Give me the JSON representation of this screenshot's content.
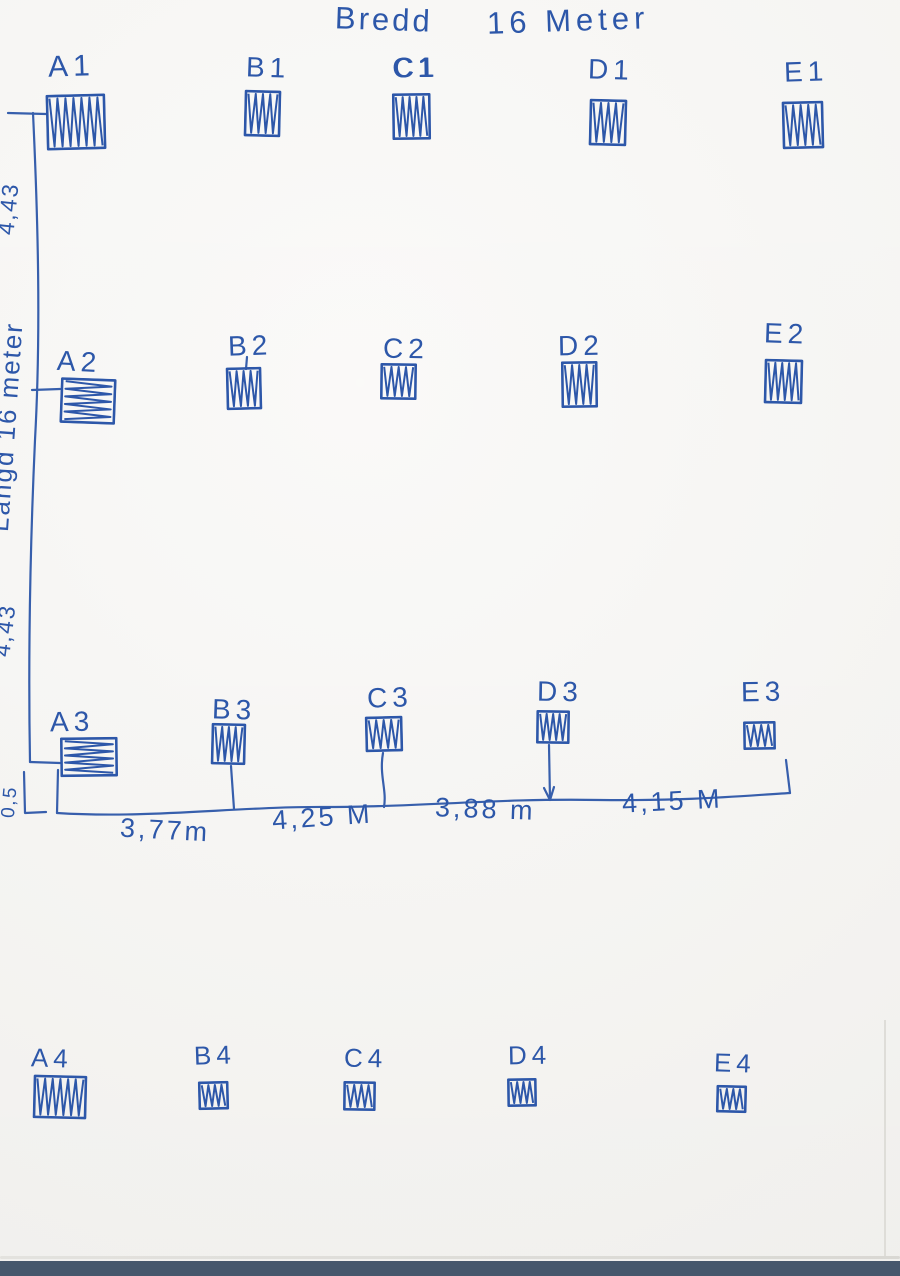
{
  "title": {
    "bredd": "Bredd",
    "width_value": "16 Meter"
  },
  "left_axis": {
    "segment_top": "4,43",
    "length_label": "Långd  16 meter",
    "segment_mid": "4,43",
    "offset_bottom": "0,5"
  },
  "bottom_axis": {
    "segments": [
      "3,77m",
      "4,25 M",
      "3,88 m",
      "4,15 M"
    ]
  },
  "ink_color": "#2d57a9",
  "paper_color": "#f8f7f4",
  "scanner_strip_color": "#46576c",
  "grid": {
    "rows": 4,
    "columns": 5,
    "row_ids": [
      "1",
      "2",
      "3",
      "4"
    ],
    "column_ids": [
      "A",
      "B",
      "C",
      "D",
      "E"
    ]
  },
  "units": [
    {
      "id": "A1",
      "label": "A1",
      "row": 1,
      "col": "A",
      "x": 46,
      "y": 94,
      "w": 60,
      "h": 56,
      "hatch": "v",
      "lx": 48,
      "ly": 50,
      "fs": 30,
      "tilt": -2,
      "bold": false
    },
    {
      "id": "B1",
      "label": "B1",
      "row": 1,
      "col": "B",
      "x": 244,
      "y": 90,
      "w": 37,
      "h": 47,
      "hatch": "v",
      "lx": 246,
      "ly": 52,
      "fs": 28,
      "tilt": 2,
      "bold": false
    },
    {
      "id": "C1",
      "label": "C1",
      "row": 1,
      "col": "C",
      "x": 392,
      "y": 93,
      "w": 39,
      "h": 47,
      "hatch": "v",
      "lx": 393,
      "ly": 52,
      "fs": 28,
      "tilt": -1,
      "bold": true
    },
    {
      "id": "D1",
      "label": "D1",
      "row": 1,
      "col": "D",
      "x": 589,
      "y": 99,
      "w": 38,
      "h": 47,
      "hatch": "v",
      "lx": 588,
      "ly": 54,
      "fs": 28,
      "tilt": 2,
      "bold": false
    },
    {
      "id": "E1",
      "label": "E1",
      "row": 1,
      "col": "E",
      "x": 782,
      "y": 101,
      "w": 42,
      "h": 48,
      "hatch": "v",
      "lx": 784,
      "ly": 56,
      "fs": 28,
      "tilt": -2,
      "bold": false
    },
    {
      "id": "A2",
      "label": "A2",
      "row": 2,
      "col": "A",
      "x": 60,
      "y": 378,
      "w": 56,
      "h": 46,
      "hatch": "h",
      "lx": 57,
      "ly": 346,
      "fs": 28,
      "tilt": 3,
      "bold": false
    },
    {
      "id": "B2",
      "label": "B2",
      "row": 2,
      "col": "B",
      "x": 226,
      "y": 367,
      "w": 36,
      "h": 43,
      "hatch": "v",
      "lx": 228,
      "ly": 330,
      "fs": 28,
      "tilt": -2,
      "bold": false
    },
    {
      "id": "C2",
      "label": "C2",
      "row": 2,
      "col": "C",
      "x": 380,
      "y": 363,
      "w": 37,
      "h": 37,
      "hatch": "v",
      "lx": 383,
      "ly": 333,
      "fs": 28,
      "tilt": 1,
      "bold": false
    },
    {
      "id": "D2",
      "label": "D2",
      "row": 2,
      "col": "D",
      "x": 561,
      "y": 361,
      "w": 37,
      "h": 47,
      "hatch": "v",
      "lx": 558,
      "ly": 330,
      "fs": 28,
      "tilt": -1,
      "bold": false
    },
    {
      "id": "E2",
      "label": "E2",
      "row": 2,
      "col": "E",
      "x": 764,
      "y": 359,
      "w": 39,
      "h": 45,
      "hatch": "v",
      "lx": 764,
      "ly": 318,
      "fs": 28,
      "tilt": 2,
      "bold": false
    },
    {
      "id": "A3",
      "label": "A3",
      "row": 3,
      "col": "A",
      "x": 60,
      "y": 737,
      "w": 58,
      "h": 40,
      "hatch": "h",
      "lx": 50,
      "ly": 706,
      "fs": 28,
      "tilt": -1,
      "bold": false
    },
    {
      "id": "B3",
      "label": "B3",
      "row": 3,
      "col": "B",
      "x": 211,
      "y": 723,
      "w": 35,
      "h": 42,
      "hatch": "v",
      "lx": 212,
      "ly": 694,
      "fs": 28,
      "tilt": 2,
      "bold": false
    },
    {
      "id": "C3",
      "label": "C3",
      "row": 3,
      "col": "C",
      "x": 365,
      "y": 716,
      "w": 38,
      "h": 36,
      "hatch": "v",
      "lx": 367,
      "ly": 682,
      "fs": 28,
      "tilt": -2,
      "bold": false
    },
    {
      "id": "D3",
      "label": "D3",
      "row": 3,
      "col": "D",
      "x": 536,
      "y": 710,
      "w": 34,
      "h": 34,
      "hatch": "v",
      "lx": 537,
      "ly": 676,
      "fs": 28,
      "tilt": 1,
      "bold": false
    },
    {
      "id": "E3",
      "label": "E3",
      "row": 3,
      "col": "E",
      "x": 743,
      "y": 721,
      "w": 33,
      "h": 29,
      "hatch": "v",
      "lx": 741,
      "ly": 676,
      "fs": 28,
      "tilt": -1,
      "bold": false
    },
    {
      "id": "A4",
      "label": "A4",
      "row": 4,
      "col": "A",
      "x": 33,
      "y": 1075,
      "w": 54,
      "h": 44,
      "hatch": "v",
      "lx": 31,
      "ly": 1043,
      "fs": 26,
      "tilt": 2,
      "bold": false
    },
    {
      "id": "B4",
      "label": "B4",
      "row": 4,
      "col": "B",
      "x": 198,
      "y": 1081,
      "w": 31,
      "h": 29,
      "hatch": "v",
      "lx": 194,
      "ly": 1040,
      "fs": 26,
      "tilt": -2,
      "bold": false
    },
    {
      "id": "C4",
      "label": "C4",
      "row": 4,
      "col": "C",
      "x": 343,
      "y": 1081,
      "w": 33,
      "h": 30,
      "hatch": "v",
      "lx": 344,
      "ly": 1043,
      "fs": 26,
      "tilt": 1,
      "bold": false
    },
    {
      "id": "D4",
      "label": "D4",
      "row": 4,
      "col": "D",
      "x": 507,
      "y": 1078,
      "w": 30,
      "h": 29,
      "hatch": "v",
      "lx": 508,
      "ly": 1040,
      "fs": 26,
      "tilt": -1,
      "bold": false
    },
    {
      "id": "E4",
      "label": "E4",
      "row": 4,
      "col": "E",
      "x": 716,
      "y": 1085,
      "w": 31,
      "h": 28,
      "hatch": "v",
      "lx": 714,
      "ly": 1048,
      "fs": 26,
      "tilt": 2,
      "bold": false
    }
  ]
}
